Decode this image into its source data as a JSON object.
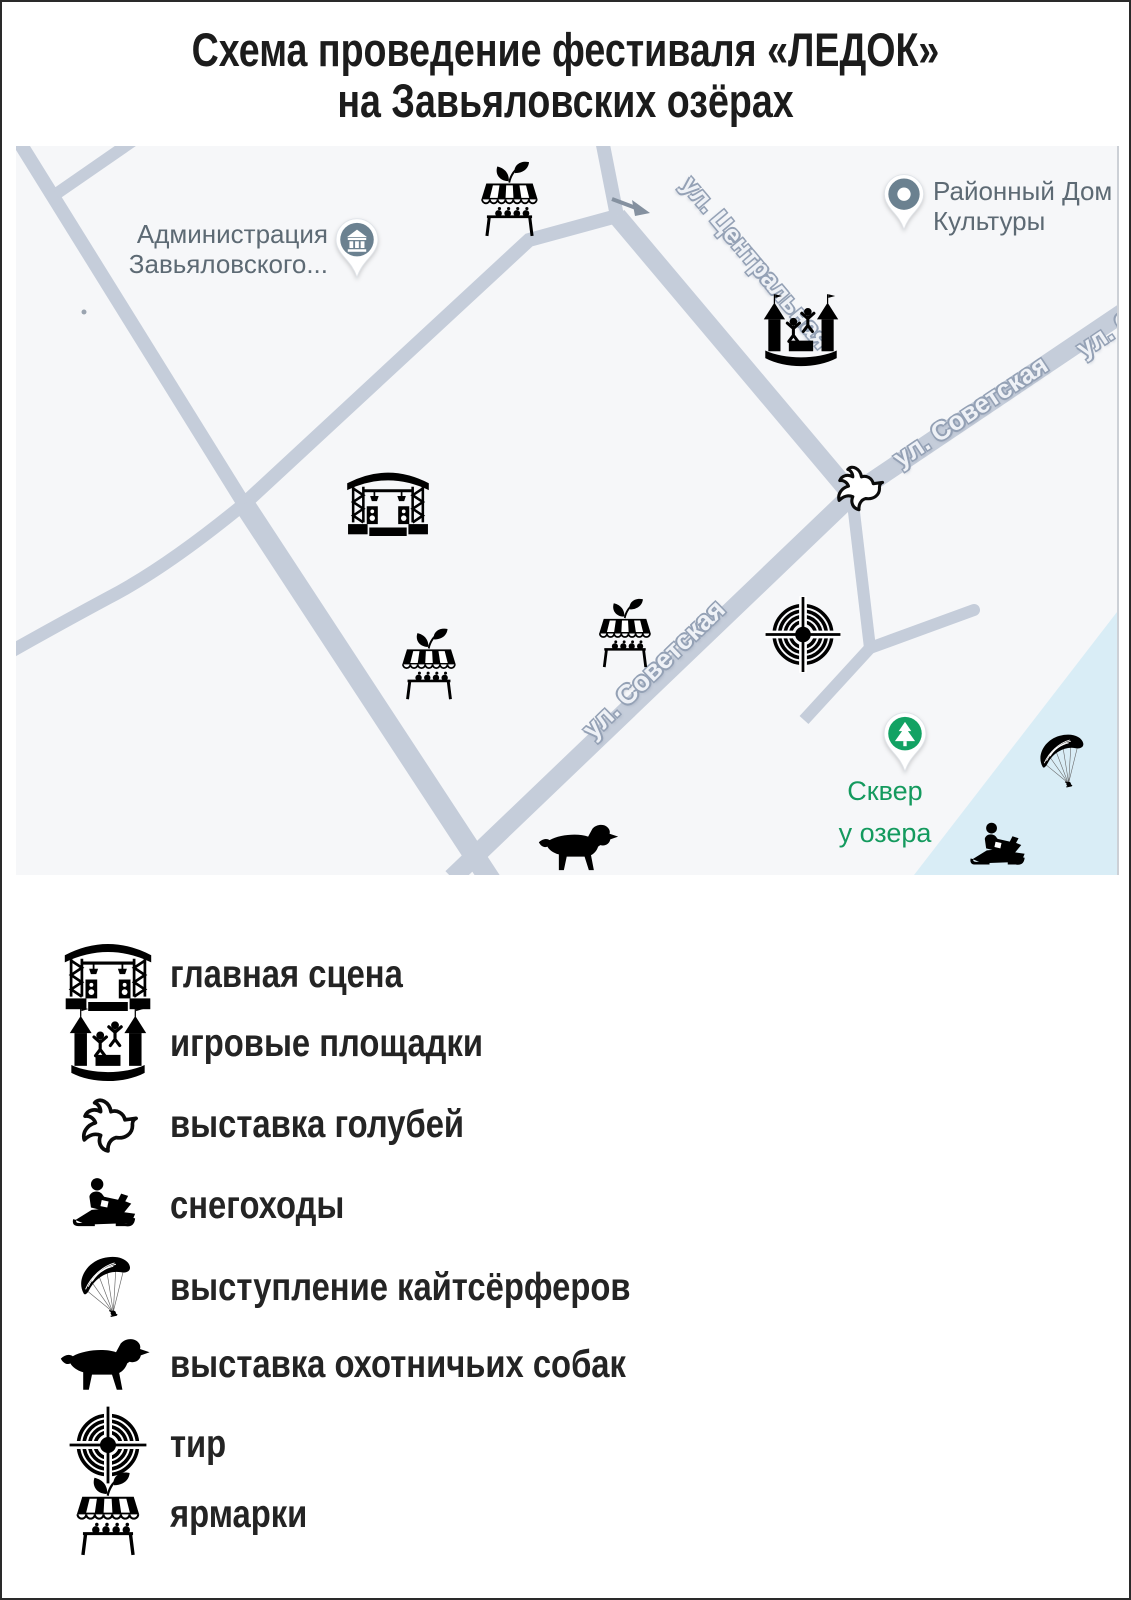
{
  "title": {
    "line1": "Схема проведение фестиваля «ЛЕДОК»",
    "line2": "на Завьяловских озёрах"
  },
  "map": {
    "pins": {
      "administration": {
        "line1": "Администрация",
        "line2": "Завьяловского...",
        "icon": "government-building-pin-icon",
        "color": "#6b8190"
      },
      "culture_house": {
        "line1": "Районный Дом",
        "line2": "Культуры",
        "icon": "place-dot-pin-icon",
        "color": "#6b8190"
      },
      "park": {
        "line1": "Сквер",
        "line2": "у озера",
        "icon": "park-tree-pin-icon",
        "color": "#12a263"
      }
    },
    "street_labels": {
      "tsentralnaya": "ул. Центральная",
      "sovetskaya_upper": "ул. Советская",
      "sovetskaya_upper_cut": "ул. С",
      "sovetskaya_lower": "ул. Советская"
    },
    "markers": [
      {
        "name": "fair-north",
        "icon": "fair-stall-icon"
      },
      {
        "name": "playground",
        "icon": "bouncy-castle-icon"
      },
      {
        "name": "dove-exhibition",
        "icon": "dove-icon"
      },
      {
        "name": "main-stage",
        "icon": "stage-icon"
      },
      {
        "name": "fair-west",
        "icon": "fair-stall-icon"
      },
      {
        "name": "fair-center",
        "icon": "fair-stall-icon"
      },
      {
        "name": "shooting-range",
        "icon": "target-icon"
      },
      {
        "name": "kitesurfers",
        "icon": "kitesurf-icon"
      },
      {
        "name": "snowmobiles",
        "icon": "snowmobile-icon"
      },
      {
        "name": "dog-show",
        "icon": "hunting-dog-icon"
      }
    ],
    "one_way_arrow": "one-way-arrow-icon"
  },
  "legend": {
    "items": [
      {
        "icon": "stage-icon",
        "label": "главная сцена"
      },
      {
        "icon": "bouncy-castle-icon",
        "label": "игровые площадки"
      },
      {
        "icon": "dove-icon",
        "label": "выставка голубей"
      },
      {
        "icon": "snowmobile-icon",
        "label": "снегоходы"
      },
      {
        "icon": "kitesurf-icon",
        "label": "выступление кайтсёрферов"
      },
      {
        "icon": "hunting-dog-icon",
        "label": "выставка охотничьих собак"
      },
      {
        "icon": "target-icon",
        "label": "тир"
      },
      {
        "icon": "fair-stall-icon",
        "label": "ярмарки"
      }
    ]
  },
  "colors": {
    "street": "#c5cdda",
    "map_background": "#f6f7f9",
    "lake": "#d9edf6",
    "pin_slate": "#6b8190",
    "pin_green": "#12a263",
    "map_label_gray": "#5d6a74",
    "map_label_green": "#149a5e",
    "text": "#242424"
  }
}
